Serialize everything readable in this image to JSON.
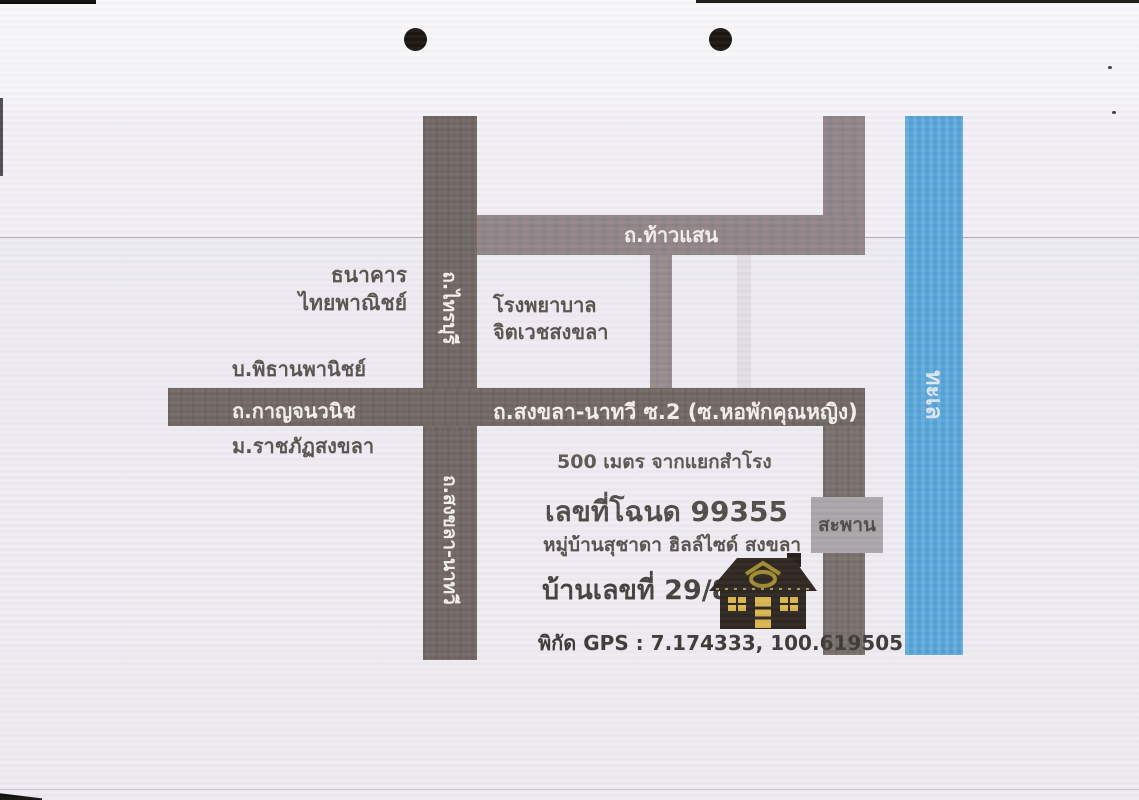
{
  "roads": {
    "thao_saen": "ถ.ท้าวแสน",
    "sai_buri": "ถ.ไทรบุรี",
    "songkhla_nathawi_vertical": "ถ.สงขลา-นาทวี",
    "kanchanavanich": "ถ.กาญจนวนิช",
    "songkhla_nathawi_soi2": "ถ.สงขลา-นาทวี ซ.2 (ซ.หอพักคุณหญิง)"
  },
  "water": {
    "sea": "ทะเล"
  },
  "bridge": {
    "label": "สะพาน"
  },
  "places": {
    "bank_line1": "ธนาคาร",
    "bank_line2": "ไทยพาณิชย์",
    "hospital_line1": "โรงพยาบาล",
    "hospital_line2": "จิตเวชสงขลา",
    "company": "บ.พิธานพานิชย์",
    "university": "ม.ราชภัฏสงขลา"
  },
  "property": {
    "distance_note": "500 เมตร จากแยกสำโรง",
    "deed_number": "เลขที่โฉนด 99355",
    "village": "หมู่บ้านสุชาดา ฮิลล์ไซด์ สงขลา",
    "house_number": "บ้านเลขที่ 29/85",
    "gps": "พิกัด GPS : 7.174333, 100.619505"
  },
  "colors": {
    "road_dark": "#6f6661",
    "road_light": "#8e8486",
    "sea_blue": "#57a6da",
    "bridge_gray": "#a8a5a9",
    "label_text": "#57504c",
    "road_label_text": "#f3efeb",
    "house_body": "#2b241e",
    "house_window": "#d8b54d"
  }
}
